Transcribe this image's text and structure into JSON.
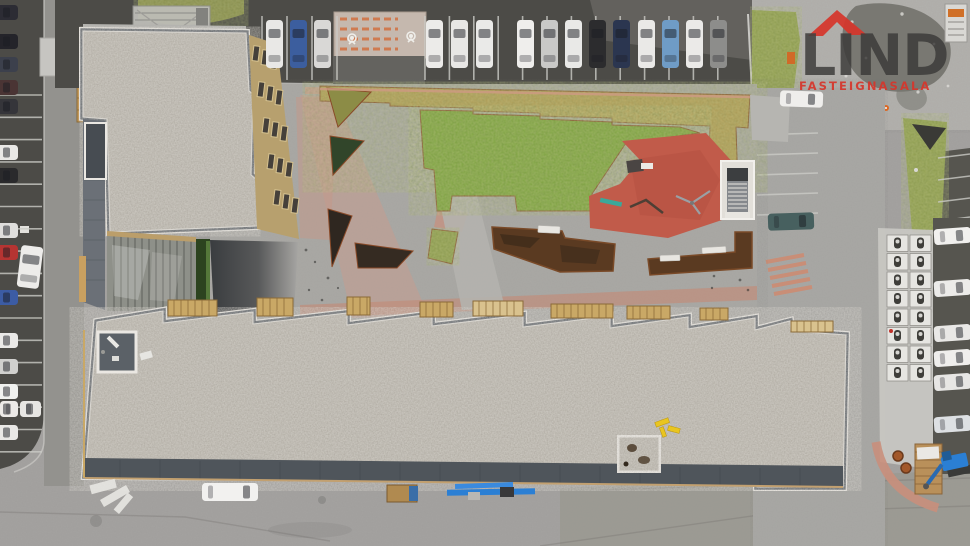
{
  "meta": {
    "type": "aerial-drone-photograph",
    "description": "Top-down aerial view of an apartment complex with two gravel-topped buildings, a landscaped courtyard with lawn and red playground, and surrounding parking lots with cars"
  },
  "watermark": {
    "title": "LIND",
    "subtitle": "FASTEIGNASALA",
    "title_color": "#3b3a38",
    "accent_color": "#d6362c"
  },
  "scene": {
    "palette": {
      "ground": "#a4a3a0",
      "asphalt": "#4c4b47",
      "asphalt_light": "#6f6e69",
      "lane": "#93928e",
      "sidewalk": "#b5b4b0",
      "road": "#a9a8a5",
      "gravel": "#b7b2a9",
      "slate": "#575d64",
      "slate_light": "#6b7077",
      "trim": "#eae7e2",
      "lawn": "#7da43b",
      "sod": "#b19d56",
      "grass": "#8f9e4e",
      "hedge": "#2c431f",
      "playground": "#c15b4a",
      "pink": "#cb9b8b",
      "pink_deep": "#c98f7c",
      "corten": "#5a3a21",
      "bed_dark": "#2f2720",
      "wood": "#c9a866",
      "facade": "#b7a06e",
      "glass": "#8e9089",
      "concrete": "#c7c6c2",
      "lot_dark": "#56554f",
      "teal_car": "#47605f",
      "machine_blue": "#2b7fd4",
      "safety_yellow": "#e9c51f",
      "cone_orange": "#e06820",
      "rust": "#8a4a28",
      "white_paint": "#e9e8e4",
      "crossing_stripe": "#cf7a50"
    },
    "inventory": {
      "buildings": 2,
      "top_row_cars": 15,
      "left_column_cars": 17,
      "right_column_cars": 6,
      "motorcycle_stalls": 16,
      "playground_items": 4,
      "benches": 3
    },
    "cars": {
      "top_row": [
        {
          "x": 266,
          "c": "#e9e8e6"
        },
        {
          "x": 290,
          "c": "#3c5e9e"
        },
        {
          "x": 314,
          "c": "#d9d8d6"
        },
        {
          "x": 426,
          "c": "#ecebe9"
        },
        {
          "x": 451,
          "c": "#e8e7e5"
        },
        {
          "x": 476,
          "c": "#eaeae8"
        },
        {
          "x": 517,
          "c": "#efeeec"
        },
        {
          "x": 541,
          "c": "#c9c9c7"
        },
        {
          "x": 565,
          "c": "#e9e9e7"
        },
        {
          "x": 589,
          "c": "#2c2c2e"
        },
        {
          "x": 613,
          "c": "#2b3650"
        },
        {
          "x": 638,
          "c": "#eae9e7"
        },
        {
          "x": 662,
          "c": "#6f9cc6"
        },
        {
          "x": 686,
          "c": "#ebeae8"
        },
        {
          "x": 710,
          "c": "#8d8d8b"
        }
      ],
      "left_col": [
        {
          "y": 5,
          "c": "#2c2c34"
        },
        {
          "y": 34,
          "c": "#24242a"
        },
        {
          "y": 57,
          "c": "#3c404c"
        },
        {
          "y": 80,
          "c": "#4a3434"
        },
        {
          "y": 99,
          "c": "#35353a"
        },
        {
          "y": 145,
          "c": "#e9e8e6"
        },
        {
          "y": 168,
          "c": "#2a2a2c"
        },
        {
          "y": 223,
          "c": "#dfdedc"
        },
        {
          "y": 245,
          "c": "#b63432"
        },
        {
          "y": 290,
          "c": "#3c5ca4"
        },
        {
          "y": 333,
          "c": "#eae9e7"
        },
        {
          "y": 359,
          "c": "#d0d0ce"
        },
        {
          "y": 384,
          "c": "#f0f1ef"
        },
        {
          "y": 425,
          "c": "#e9e8e6"
        }
      ],
      "left_bottom": [
        {
          "x": 0,
          "y": 401,
          "w": 18,
          "h": 16,
          "c": "#eceae7"
        },
        {
          "x": 20,
          "y": 401,
          "w": 21,
          "h": 16,
          "c": "#e7e6e3"
        }
      ],
      "angled": {
        "x": 19,
        "y": 246,
        "w": 22,
        "h": 42,
        "c": "#edecea",
        "rot": 7
      },
      "right_col": [
        {
          "y": 228,
          "c": "#f1f0ee"
        },
        {
          "y": 280,
          "c": "#ecebe9"
        },
        {
          "y": 325,
          "c": "#e9e8e6"
        },
        {
          "y": 350,
          "c": "#efeeec"
        },
        {
          "y": 374,
          "c": "#e7e6e4"
        },
        {
          "y": 416,
          "c": "#dde0e3"
        }
      ],
      "misc": [
        {
          "x": 768,
          "y": 213,
          "w": 46,
          "h": 17,
          "c": "#47605f",
          "rot": -2,
          "name": "teal-car"
        },
        {
          "x": 780,
          "y": 91,
          "w": 43,
          "h": 16,
          "c": "#efeeec",
          "rot": 2,
          "name": "white-car"
        },
        {
          "x": 202,
          "y": 483,
          "w": 56,
          "h": 18,
          "c": "#f2f1ef",
          "rot": 0,
          "name": "delivery-van"
        }
      ]
    },
    "stripes": [
      {
        "type": "v",
        "x0": 262,
        "x1": 338,
        "step": 25,
        "y0": 16,
        "y1": 80
      },
      {
        "type": "v",
        "x0": 425,
        "x1": 742,
        "step": 24.4,
        "y0": 16,
        "y1": 80
      },
      {
        "type": "h",
        "y0": 95,
        "y1": 452,
        "step": 22.3,
        "x0": 0,
        "x1": 42,
        "slant": 0
      },
      {
        "type": "h",
        "y0": 135,
        "y1": 215,
        "step": 20,
        "x0": 756,
        "x1": 818,
        "slant": -2
      },
      {
        "type": "h",
        "y0": 158,
        "y1": 312,
        "step": 22,
        "x0": 938,
        "x1": 970,
        "slant": -4
      },
      {
        "type": "h",
        "y0": 222,
        "y1": 470,
        "step": 24.6,
        "x0": 933,
        "x1": 970,
        "slant": -5
      }
    ],
    "carports": {
      "x0": 886,
      "y0": 234,
      "cols": 2,
      "rows": 8,
      "cw": 23,
      "ch": 18.5
    },
    "windows": [
      [
        253,
        46
      ],
      [
        262,
        50
      ],
      [
        271,
        54
      ],
      [
        258,
        82
      ],
      [
        267,
        86
      ],
      [
        276,
        90
      ],
      [
        263,
        118
      ],
      [
        272,
        122
      ],
      [
        281,
        126
      ],
      [
        268,
        154
      ],
      [
        277,
        158
      ],
      [
        286,
        162
      ],
      [
        274,
        190
      ],
      [
        283,
        194
      ],
      [
        292,
        198
      ]
    ],
    "lumber": [
      [
        168,
        300,
        49,
        16,
        0
      ],
      [
        257,
        298,
        36,
        18,
        0
      ],
      [
        347,
        297,
        23,
        18,
        0
      ],
      [
        420,
        302,
        33,
        15,
        0
      ],
      [
        473,
        301,
        50,
        15,
        1
      ],
      [
        551,
        304,
        62,
        14,
        0
      ],
      [
        627,
        306,
        43,
        13,
        0
      ],
      [
        700,
        308,
        28,
        12,
        0
      ],
      [
        791,
        321,
        42,
        11,
        1
      ]
    ]
  }
}
